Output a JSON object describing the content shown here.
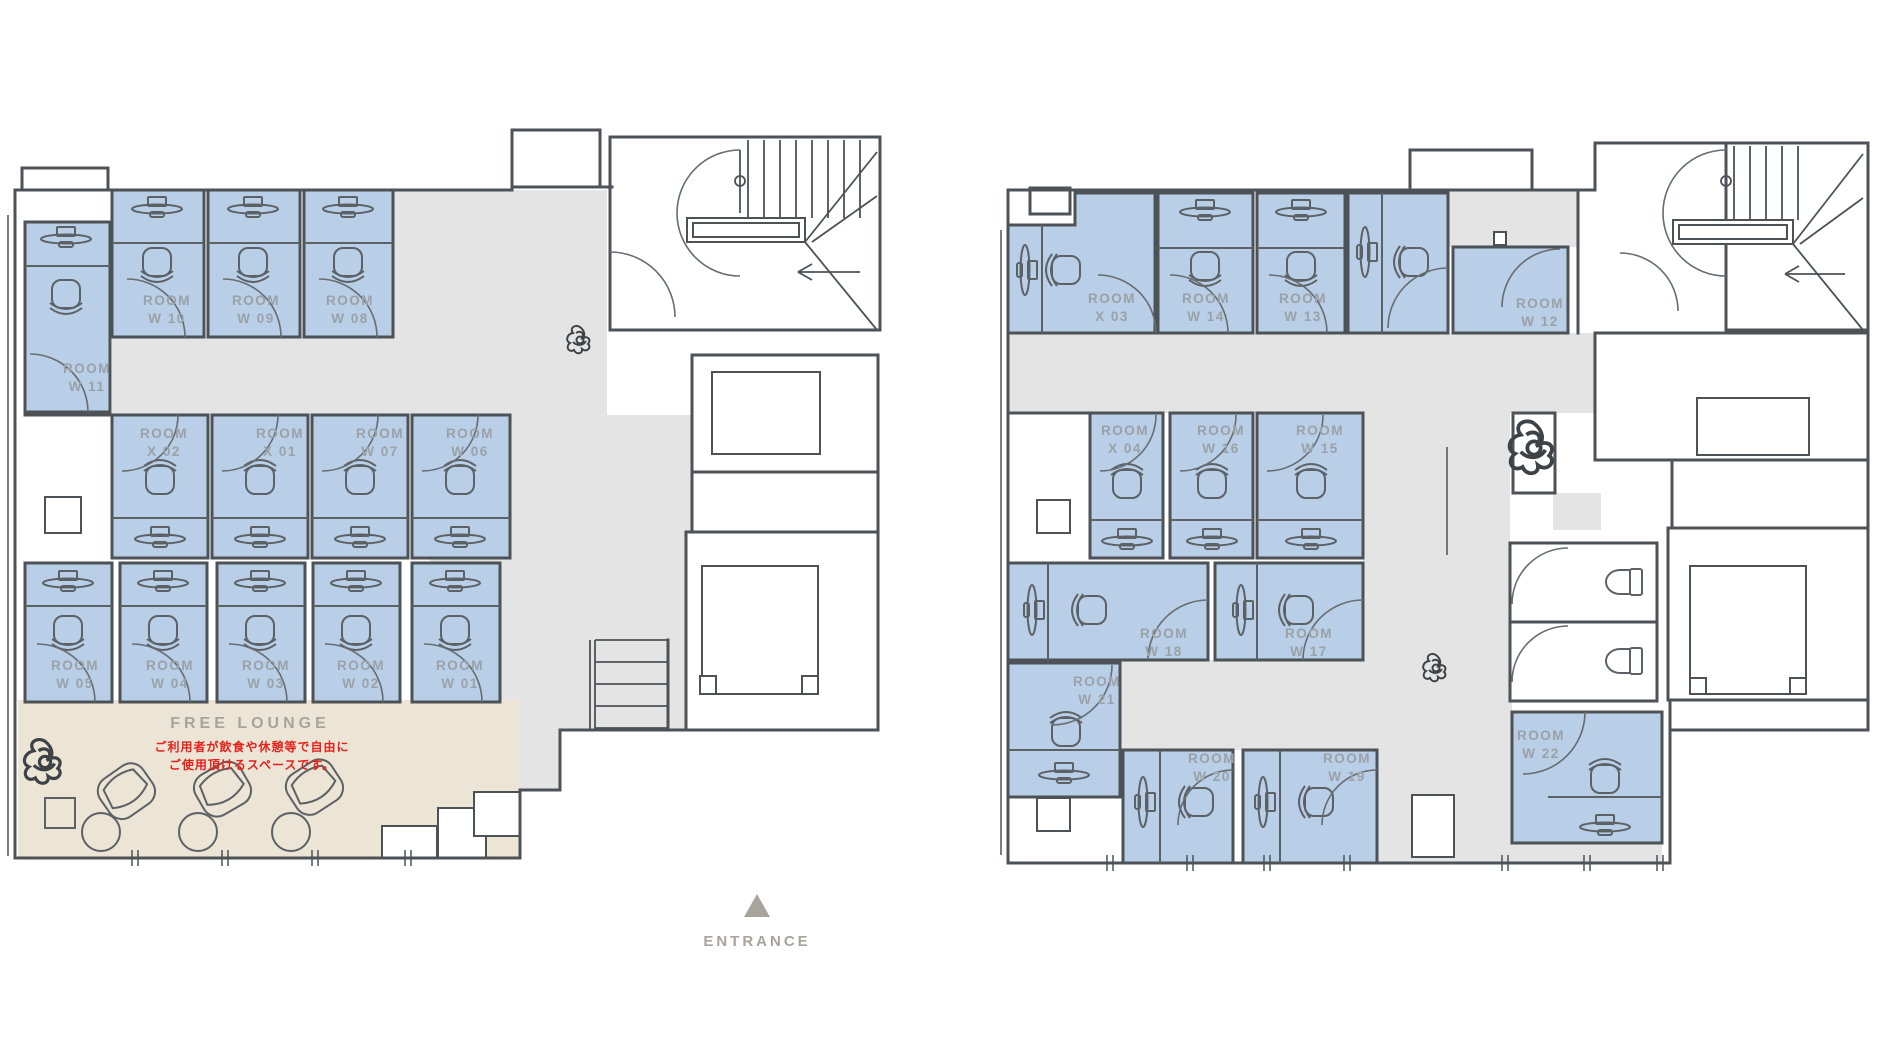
{
  "colors": {
    "wall": "#4d5257",
    "room_fill": "#b9cee7",
    "corridor_fill": "#e4e4e4",
    "lounge_fill": "#ece4d5",
    "room_label": "#9aa1a7",
    "note_red": "#e5211c",
    "muted_text": "#a8a39b"
  },
  "plans": [
    {
      "id": "left",
      "rooms": [
        {
          "id": "room-w10",
          "label": "ROOM",
          "number": "W 10",
          "x": 167,
          "y": 305
        },
        {
          "id": "room-w09",
          "label": "ROOM",
          "number": "W 09",
          "x": 256,
          "y": 305
        },
        {
          "id": "room-w08",
          "label": "ROOM",
          "number": "W 08",
          "x": 350,
          "y": 305
        },
        {
          "id": "room-w11",
          "label": "ROOM",
          "number": "W 11",
          "x": 87,
          "y": 373
        },
        {
          "id": "room-x02",
          "label": "ROOM",
          "number": "X 02",
          "x": 164,
          "y": 438
        },
        {
          "id": "room-x01",
          "label": "ROOM",
          "number": "X 01",
          "x": 280,
          "y": 438
        },
        {
          "id": "room-w07",
          "label": "ROOM",
          "number": "W 07",
          "x": 380,
          "y": 438
        },
        {
          "id": "room-w06",
          "label": "ROOM",
          "number": "W 06",
          "x": 470,
          "y": 438
        },
        {
          "id": "room-w05",
          "label": "ROOM",
          "number": "W 05",
          "x": 75,
          "y": 670
        },
        {
          "id": "room-w04",
          "label": "ROOM",
          "number": "W 04",
          "x": 170,
          "y": 670
        },
        {
          "id": "room-w03",
          "label": "ROOM",
          "number": "W 03",
          "x": 266,
          "y": 670
        },
        {
          "id": "room-w02",
          "label": "ROOM",
          "number": "W 02",
          "x": 361,
          "y": 670
        },
        {
          "id": "room-w01",
          "label": "ROOM",
          "number": "W 01",
          "x": 460,
          "y": 670
        }
      ]
    },
    {
      "id": "right",
      "rooms": [
        {
          "id": "room-x03",
          "label": "ROOM",
          "number": "X 03",
          "x": 1112,
          "y": 303
        },
        {
          "id": "room-w14",
          "label": "ROOM",
          "number": "W 14",
          "x": 1206,
          "y": 303
        },
        {
          "id": "room-w13",
          "label": "ROOM",
          "number": "W 13",
          "x": 1303,
          "y": 303
        },
        {
          "id": "room-w12",
          "label": "ROOM",
          "number": "W 12",
          "x": 1540,
          "y": 308
        },
        {
          "id": "room-x04",
          "label": "ROOM",
          "number": "X 04",
          "x": 1125,
          "y": 435
        },
        {
          "id": "room-w16",
          "label": "ROOM",
          "number": "W 16",
          "x": 1221,
          "y": 435
        },
        {
          "id": "room-w15",
          "label": "ROOM",
          "number": "W 15",
          "x": 1320,
          "y": 435
        },
        {
          "id": "room-w18",
          "label": "ROOM",
          "number": "W 18",
          "x": 1164,
          "y": 638
        },
        {
          "id": "room-w17",
          "label": "ROOM",
          "number": "W 17",
          "x": 1309,
          "y": 638
        },
        {
          "id": "room-w21",
          "label": "ROOM",
          "number": "W 21",
          "x": 1097,
          "y": 686
        },
        {
          "id": "room-w20",
          "label": "ROOM",
          "number": "W 20",
          "x": 1212,
          "y": 763
        },
        {
          "id": "room-w19",
          "label": "ROOM",
          "number": "W 19",
          "x": 1347,
          "y": 763
        },
        {
          "id": "room-w22",
          "label": "ROOM",
          "number": "W 22",
          "x": 1541,
          "y": 740
        }
      ]
    }
  ],
  "lounge": {
    "title": "FREE LOUNGE",
    "note1": "ご利用者が飲食や休憩等で自由に",
    "note2": "ご使用頂けるスペースです。"
  },
  "entrance": {
    "label": "ENTRANCE"
  }
}
